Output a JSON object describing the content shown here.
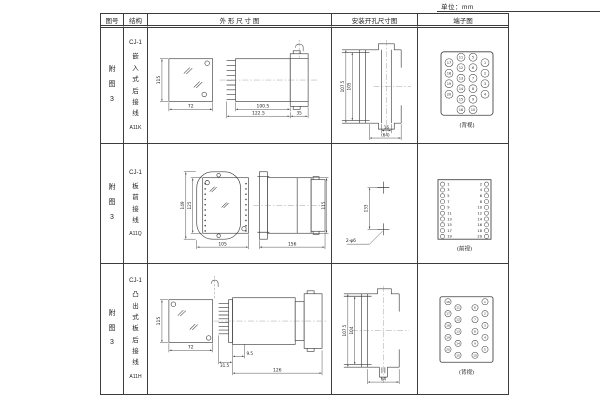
{
  "page": {
    "unit_label": "单位：mm"
  },
  "header": {
    "figure": "图号",
    "structure": "结构",
    "outline": "外 形 尺 寸 图",
    "mounting": "安装开孔尺寸图",
    "terminal": "端子图"
  },
  "rows": [
    {
      "figure": "附图3",
      "structure": {
        "model": "CJ-1",
        "name": "嵌入式后接线",
        "code": "A11K"
      },
      "outline": {
        "front_height": "115",
        "front_width": "72",
        "side_body": "100.5",
        "side_overall": "122.5",
        "side_flange": "35"
      },
      "mounting": {
        "outer_height": "107.5",
        "inner_height": "105",
        "slot_width": "16",
        "overall_width": "(64)"
      },
      "terminal": {
        "view": "(背视)",
        "nums": [
          "1",
          "2",
          "3",
          "4",
          "5",
          "6",
          "7",
          "8",
          "9",
          "10",
          "11",
          "12",
          "13",
          "14",
          "15",
          "16",
          "17",
          "18",
          "19",
          "20"
        ]
      }
    },
    {
      "figure": "附图3",
      "structure": {
        "model": "CJ-1",
        "name": "板前接线",
        "code": "A11Q"
      },
      "outline": {
        "front_outer": "149",
        "front_inner": "125",
        "front_width": "105",
        "side_length": "156",
        "side_height": "115"
      },
      "mounting": {
        "hole_pitch": "133",
        "hole_label": "2-φ6"
      },
      "terminal": {
        "view": "(前视)",
        "left": [
          "1",
          "3",
          "5",
          "7",
          "9",
          "11",
          "13",
          "15",
          "17",
          "19"
        ],
        "right": [
          "2",
          "4",
          "6",
          "8",
          "10",
          "12",
          "14",
          "16",
          "18",
          "20"
        ]
      }
    },
    {
      "figure": "附图3",
      "structure": {
        "model": "CJ-1",
        "name": "凸出式板后接线",
        "code": "A11H"
      },
      "outline": {
        "front_height": "115",
        "front_width": "72",
        "side_pins": "31.5",
        "side_offset": "9.5",
        "side_length": "126"
      },
      "mounting": {
        "outer_height": "107.5",
        "inner_height": "104",
        "overall_width": "64"
      },
      "terminal": {
        "view": "(背视)",
        "nums": [
          "1",
          "2",
          "3",
          "4",
          "5",
          "6",
          "7",
          "8",
          "9",
          "10",
          "11",
          "12",
          "13",
          "14",
          "15",
          "16",
          "17",
          "18",
          "19",
          "20"
        ]
      }
    }
  ]
}
